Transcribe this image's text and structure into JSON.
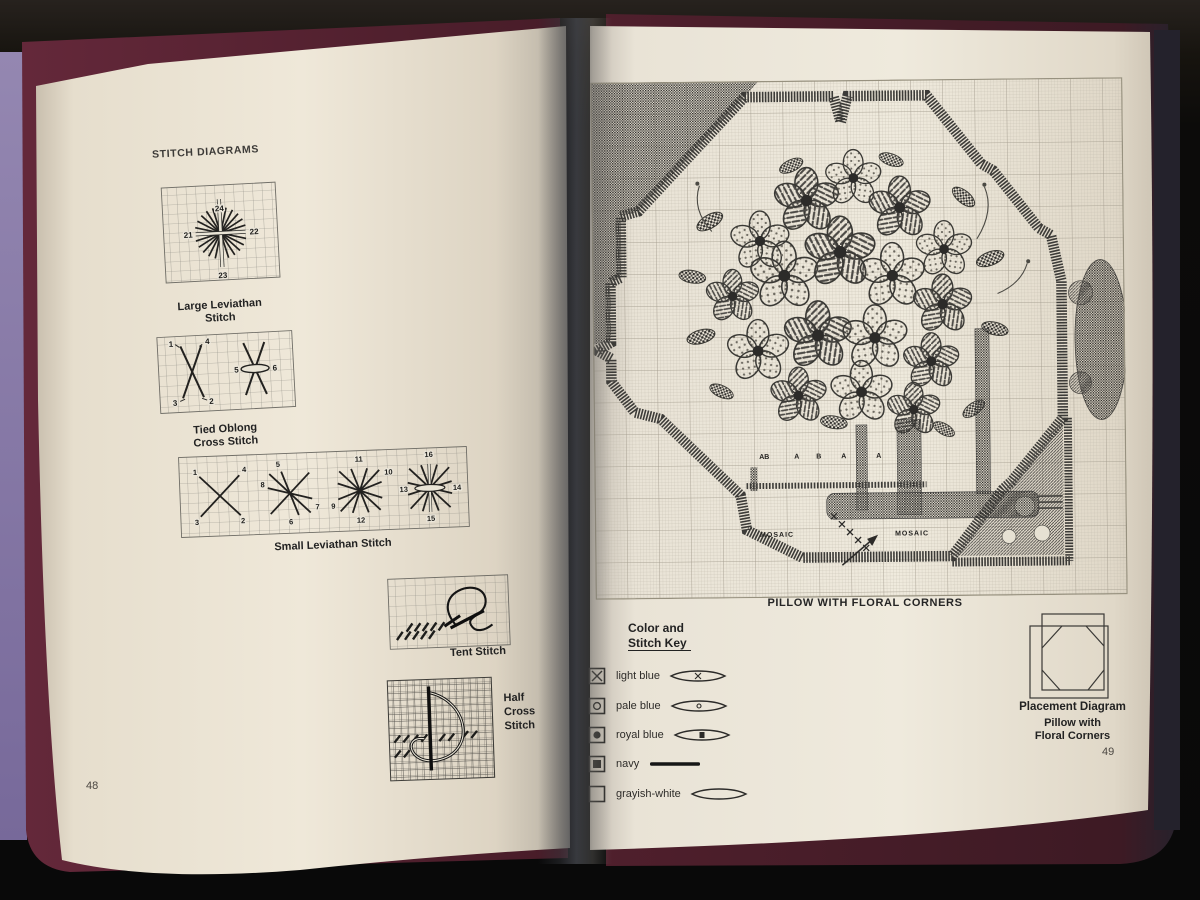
{
  "left_page": {
    "title": "STITCH DIAGRAMS",
    "page_number": "48",
    "large_leviathan": {
      "caption1": "Large Leviathan",
      "caption2": "Stitch",
      "n24": "24",
      "n21": "21",
      "n22": "22",
      "n23": "23"
    },
    "tied_oblong": {
      "caption1": "Tied Oblong",
      "caption2": "Cross Stitch",
      "n1": "1",
      "n2": "2",
      "n3": "3",
      "n4": "4",
      "n5": "5",
      "n6": "6"
    },
    "small_leviathan": {
      "caption": "Small Leviathan Stitch",
      "n1": "1",
      "n2": "2",
      "n3": "3",
      "n4": "4",
      "n5": "5",
      "n6": "6",
      "n7": "7",
      "n8": "8",
      "n9": "9",
      "n10": "10",
      "n11": "11",
      "n12": "12",
      "n13": "13",
      "n14": "14",
      "n15": "15",
      "n16": "16"
    },
    "tent": {
      "caption": "Tent Stitch"
    },
    "half_cross": {
      "caption1": "Half",
      "caption2": "Cross",
      "caption3": "Stitch"
    }
  },
  "right_page": {
    "page_number": "49",
    "chart_caption": "PILLOW WITH FLORAL CORNERS",
    "chart": {
      "letter1": "AB",
      "letter2": "A",
      "letter3": "B",
      "letter4": "A",
      "letter5": "A",
      "mosaic_left": "MOSAIC",
      "mosaic_right": "MOSAIC"
    },
    "key": {
      "title1": "Color and",
      "title2": "Stitch Key",
      "entries": [
        {
          "symbol": "x-in-box",
          "label": "light blue",
          "yarn_mark": "x"
        },
        {
          "symbol": "circle-in-box",
          "label": "pale blue",
          "yarn_mark": "o"
        },
        {
          "symbol": "dot-in-box",
          "label": "royal blue",
          "yarn_mark": "square"
        },
        {
          "symbol": "filled-square-in-box",
          "label": "navy",
          "yarn_mark": "solid-line"
        },
        {
          "symbol": "empty-box",
          "label": "grayish-white",
          "yarn_mark": "none"
        }
      ]
    },
    "placement": {
      "title": "Placement Diagram",
      "sub1": "Pillow with",
      "sub2": "Floral Corners"
    }
  },
  "colors": {
    "wall_lavender": "#8a7ca9",
    "cover_maroon": "#5a2230",
    "page_cream": "#ece5d6",
    "ink": "#2b2b2b",
    "band_dark": "#3c3b38"
  }
}
